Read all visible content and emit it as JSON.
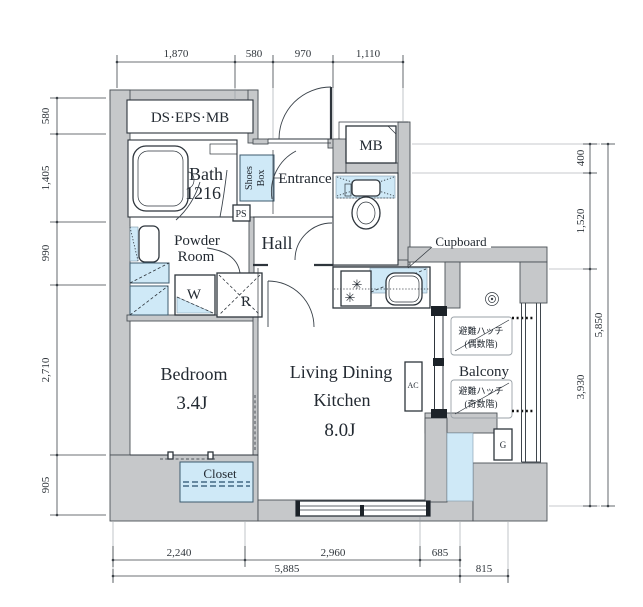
{
  "plan": {
    "labels": {
      "ds_eps_mb": "DS·EPS·MB",
      "bath": "Bath",
      "bath_size": "1216",
      "shoes_1": "Shoes",
      "shoes_2": "Box",
      "ps": "PS",
      "entrance": "Entrance",
      "mb": "MB",
      "powder_1": "Powder",
      "powder_2": "Room",
      "hall": "Hall",
      "cupboard": "Cupboard",
      "washer": "W",
      "fridge": "R",
      "bedroom": "Bedroom",
      "bedroom_size": "3.4J",
      "ldk_1": "Living Dining",
      "ldk_2": "Kitchen",
      "ldk_size": "8.0J",
      "ac": "AC",
      "closet": "Closet",
      "balcony": "Balcony",
      "hatch": "避難ハッチ",
      "hatch_even": "(偶数階)",
      "hatch_odd": "(奇数階)",
      "gas_meter": "G"
    },
    "icons": {
      "burner": "✳"
    },
    "dims": {
      "top": [
        "1,870",
        "580",
        "970",
        "1,110"
      ],
      "left": [
        "580",
        "1,405",
        "990",
        "2,710",
        "905"
      ],
      "right": [
        "400",
        "1,520",
        "3,930"
      ],
      "right_total": "5,850",
      "bottom_upper": [
        "2,240",
        "2,960",
        "685"
      ],
      "bottom_lower": [
        "5,885",
        "815"
      ]
    },
    "colors": {
      "wall": "#c6c8ca",
      "fixture_blue": "#cfe9f7",
      "line": "#2e353c"
    }
  }
}
